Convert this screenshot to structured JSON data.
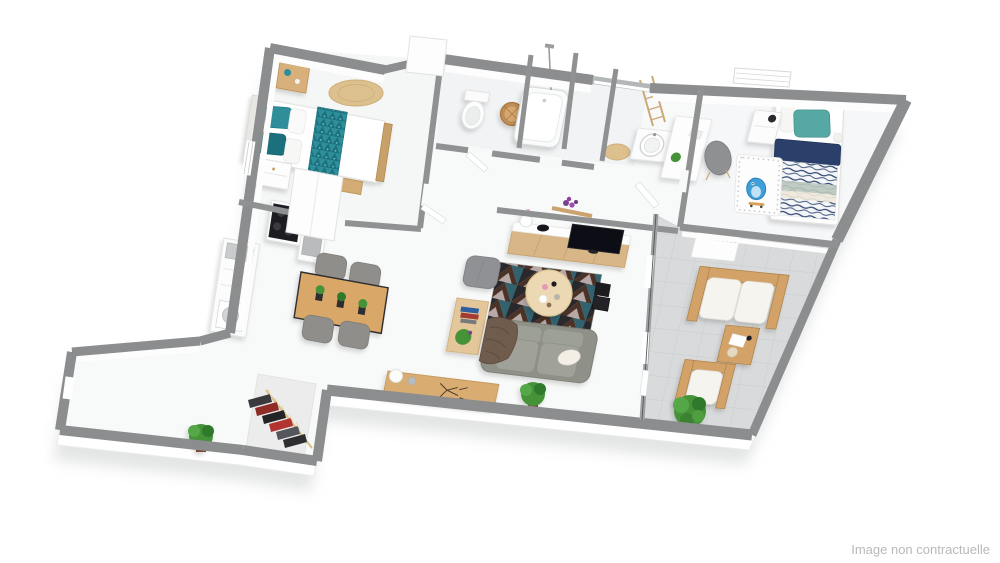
{
  "watermark": {
    "text": "Image non contractuelle"
  },
  "scene": {
    "type": "3d-floorplan-birdseye-render"
  },
  "colors": {
    "wall": "#8b8d8e",
    "wallInner": "#8f9192",
    "floor": "#f8f9f9",
    "slabShadow": "#c8cacb",
    "terrace": "#d8dadb",
    "terraceLine": "#c9cdcd",
    "wood": "#d2a269",
    "woodDark": "#b08449",
    "woodLight": "#ecd9b4",
    "teal": "#2e8e99",
    "tealDark": "#1c6f7d",
    "navy": "#2a3f6b",
    "sofa": "#94968c",
    "chairGray": "#8f8e8a",
    "green": "#459238",
    "greenDark": "#2f7a2c",
    "jute": "#dcc08e",
    "cream": "#f6f4ef",
    "black": "#1b1b1e",
    "cartoonBlue": "#3f9fd8",
    "red": "#a43b35",
    "watermark": "#b7b9ba"
  },
  "rooms": {
    "bedroom_main": [
      "double-bed",
      "teal-runner",
      "nightstand",
      "dresser",
      "jute-rug",
      "bench",
      "wardrobe"
    ],
    "wc": [
      "toilet",
      "wicker-basket"
    ],
    "bathroom": [
      "bathtub",
      "shower-column"
    ],
    "shower_room": [
      "washbasin",
      "ladder-rack",
      "jute-rug"
    ],
    "bedroom_kids": [
      "single-bed",
      "nightstand",
      "desk",
      "chair",
      "play-rug",
      "cartoon-character"
    ],
    "kitchen": [
      "sink-counter",
      "washing-machine",
      "cooktop",
      "oven-column"
    ],
    "dining": [
      "wood-table",
      "four-chairs",
      "table-plants"
    ],
    "living": [
      "tv-console",
      "tv",
      "geometric-rug",
      "round-coffee-table",
      "pouf",
      "side-table",
      "sofa",
      "throw-blanket",
      "plant",
      "shelf-flowers"
    ],
    "entry": [
      "sideboard",
      "vase",
      "plant",
      "open-closet-with-clothes"
    ],
    "terrace": [
      "outdoor-loveseat",
      "outdoor-table",
      "outdoor-armchair",
      "bush",
      "storage-box"
    ]
  }
}
